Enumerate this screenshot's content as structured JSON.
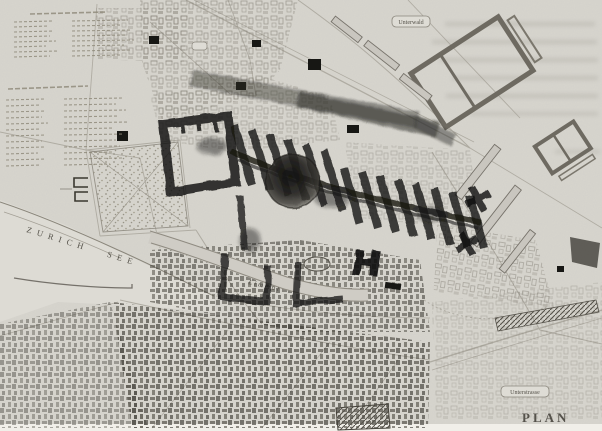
{
  "image_kind": "scanned historical city plan of Zurich with heavy black overdrawing",
  "colors": {
    "paper": "#d7d5ce",
    "paper_light": "#dedcd5",
    "page_margin": "#f1efe9",
    "map_line": "#a39f95",
    "ink_dark": "#151513",
    "ink_gray": "#5a574f",
    "label": "#4e4b43"
  },
  "labels": {
    "lake": "ZURICH SEE",
    "river": "Limmat",
    "plan": "PLAN",
    "box_top_right": "Unterwald",
    "box_bottom_right": "Unterstrasse"
  }
}
